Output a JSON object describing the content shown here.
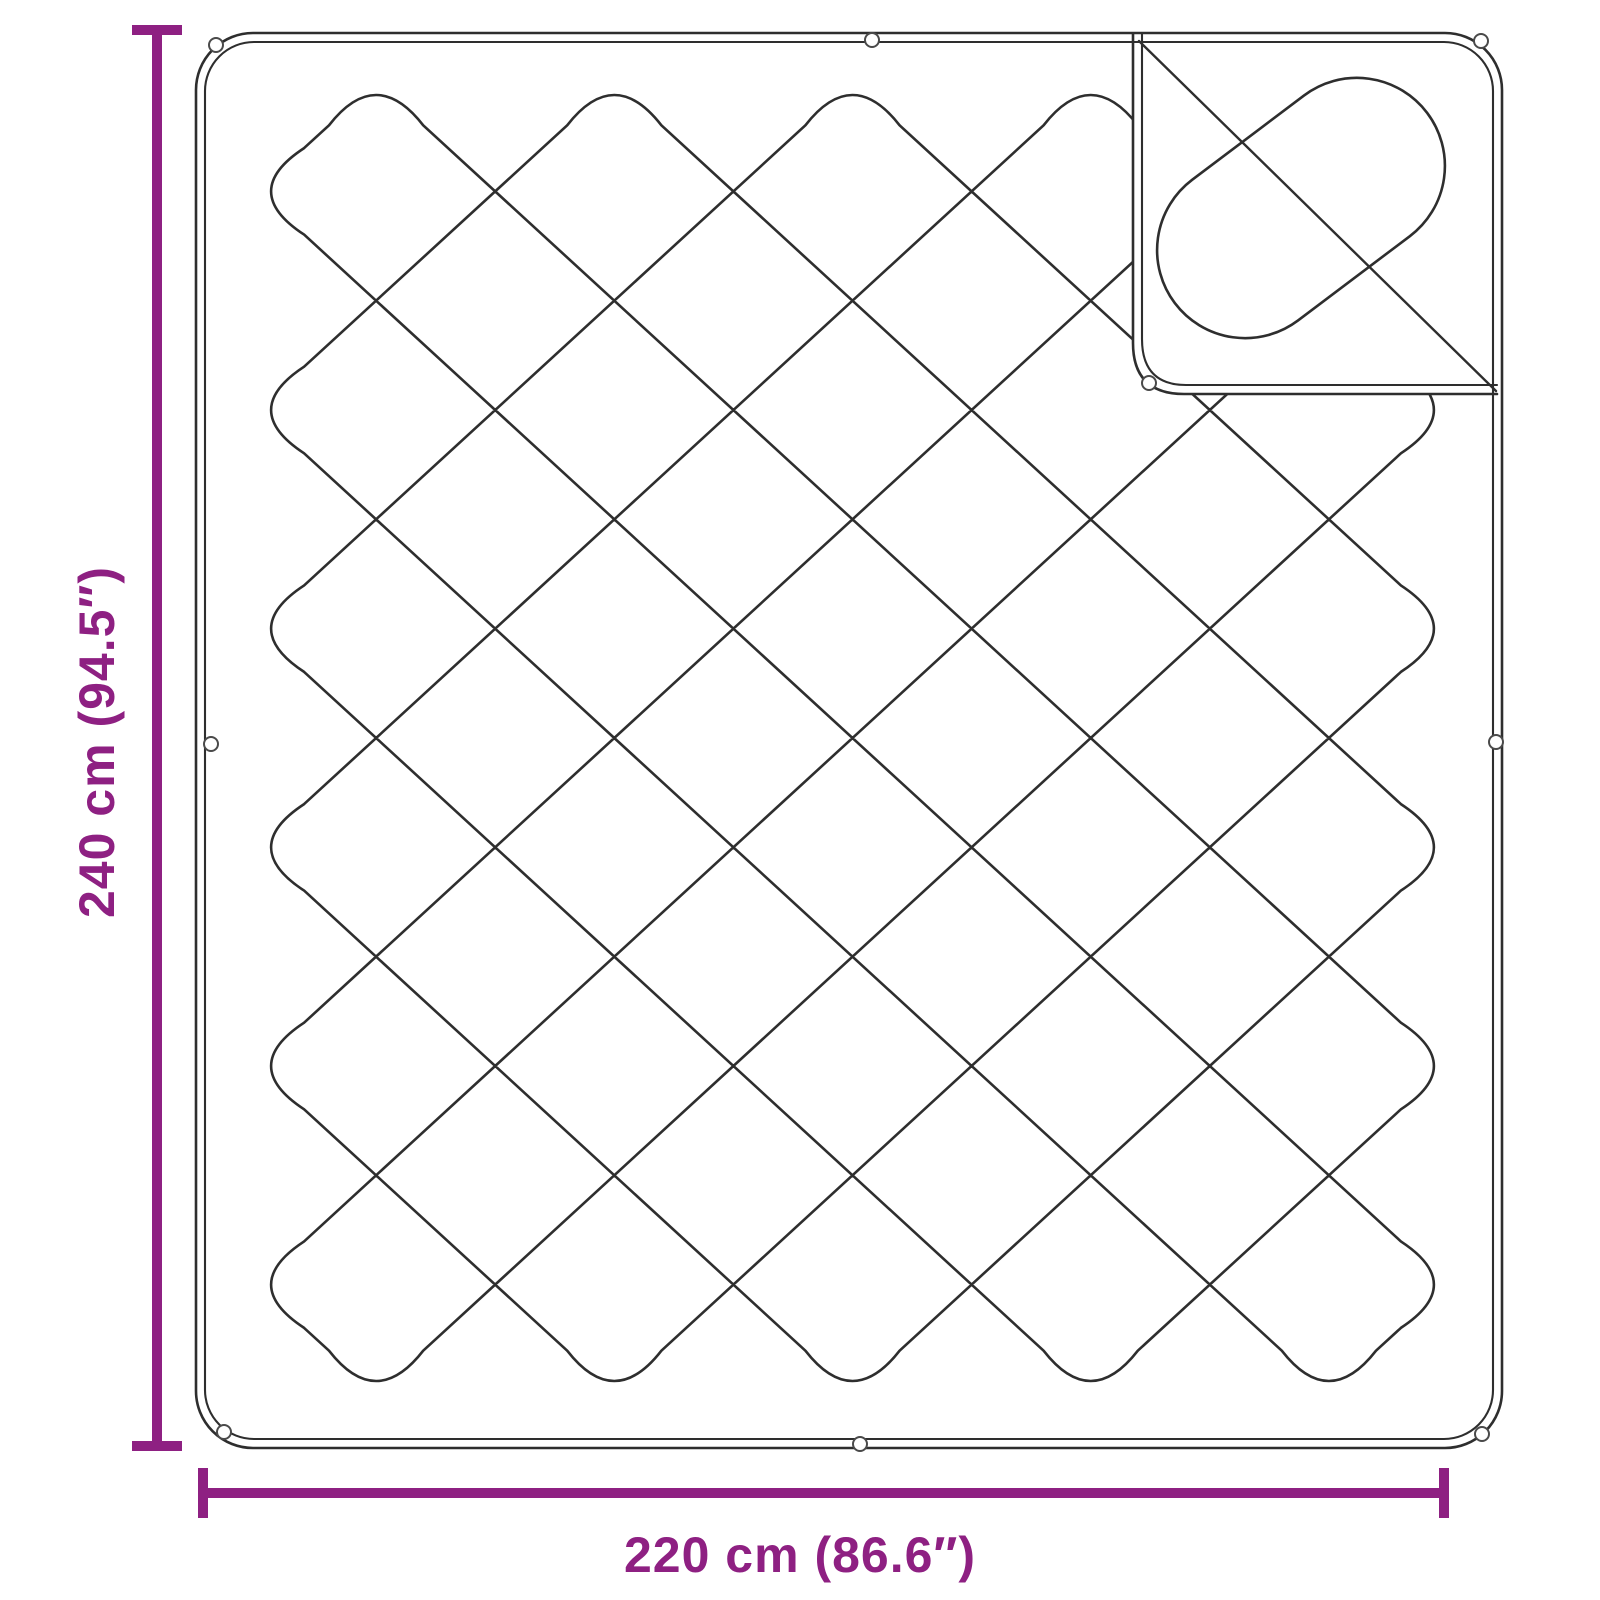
{
  "page": {
    "background_color": "#ffffff",
    "description": "Product dimension diagram of a quilted blanket / mattress topper with a folded-back corner flap"
  },
  "colors": {
    "dimension_annotation": "#8E2082",
    "drawing_outline": "#2e2e2e",
    "grommet_stroke": "#4a4a4a"
  },
  "dimensions": {
    "height": {
      "label": "240 cm (94.5″)",
      "value_cm": 240,
      "value_inch": 94.5
    },
    "width": {
      "label": "220 cm (86.6″)",
      "value_cm": 220,
      "value_inch": 86.6
    }
  },
  "blanket": {
    "style": "diamond quilted stitching with rounded edge loops",
    "border": "double stitched hem",
    "grommets": 8,
    "flap": "top-right corner folded over showing reverse side with capsule-shaped quilting and fold crease"
  }
}
